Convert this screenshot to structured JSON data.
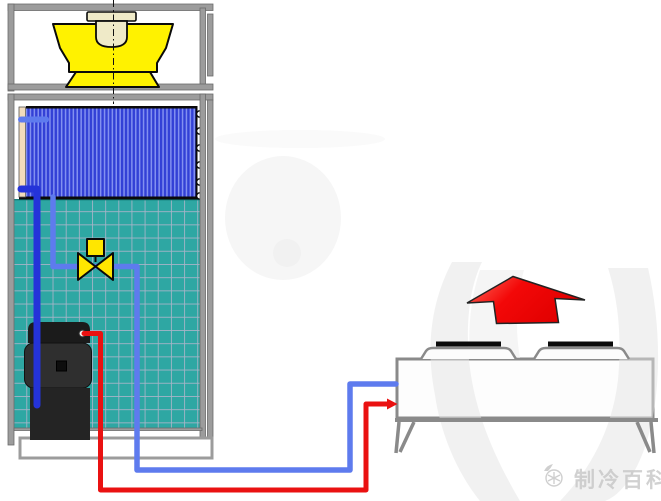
{
  "diagram": {
    "type": "refrigeration-system-schematic",
    "watermark": {
      "text": "制冷百科",
      "logo": "snowflake-badge-icon"
    },
    "components": {
      "indoor_cabinet": "packaged-air-handler-cabinet",
      "fan": "centrifugal-supply-fan",
      "fan_motor": "fan-motor",
      "coil": "finned-coil",
      "filter": "mesh-filter-panel",
      "expansion_valve": "thermal-expansion-valve",
      "compressor": "compressor",
      "outdoor_unit": "remote-air-cooled-condenser",
      "airflow": "condenser-discharge-air-arrow"
    },
    "pipes": {
      "suction_line": "dark-blue",
      "liquid_line": "light-blue",
      "discharge_line": "red"
    }
  },
  "colors": {
    "cabinet_frame": "#9C9C9C",
    "fan": "#FFF200",
    "motor": "#EFEAC8",
    "coil_dark": "#3240D6",
    "coil_light": "#8290F0",
    "coil_header": "#F2DCBC",
    "filter_teal": "#2EA7A3",
    "filter_grid": "#A8B4C8",
    "valve": "#FFE600",
    "compressor_dark": "#1B1B1B",
    "compressor_mid": "#2F2F2F",
    "pipe_suction": "#2433D9",
    "pipe_liquid": "#5E7BEE",
    "pipe_discharge": "#EA1111",
    "arrow_red": "#F30808",
    "unit_outline": "#8A8A8A",
    "watermark_gray": "#C9C9C9"
  }
}
